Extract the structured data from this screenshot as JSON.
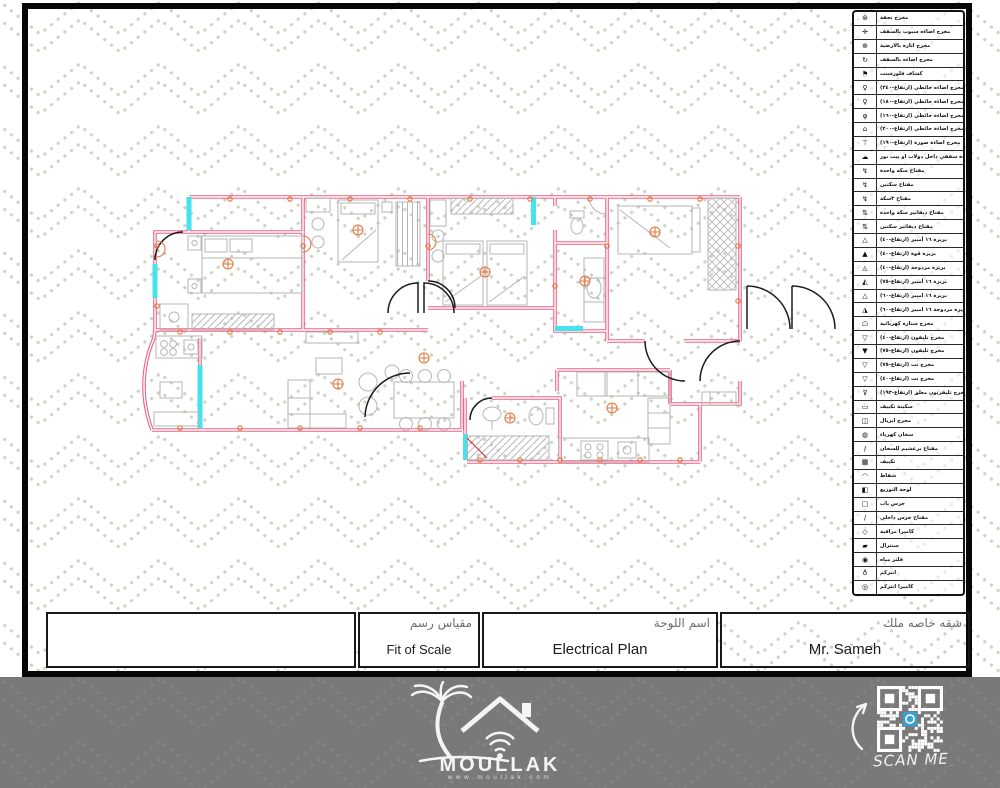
{
  "sheet": {
    "type_label": "Electrical Plan drawing sheet",
    "colors": {
      "pattern_dots": "#ccd5c3",
      "frame": "#070707",
      "walls": "#ef6285",
      "windows": "#45e2ef",
      "furniture": "#b6b6b6",
      "electric_symbols": "#e2793f",
      "doors": "#1c1c1c",
      "footer_bg": "#797979",
      "qr_center_icon": "#3aa0d6"
    }
  },
  "legend": {
    "rows": [
      {
        "icon_name": "chandelier-outlet-icon",
        "glyph": "⊛",
        "label": "مخرج نجفة"
      },
      {
        "icon_name": "ceiling-spot-light-icon",
        "glyph": "✛",
        "label": "مخرج اضاءه سبوت بالسقف"
      },
      {
        "icon_name": "floor-lighting-icon",
        "glyph": "⊕",
        "label": "مخرج انارة بالارضية"
      },
      {
        "icon_name": "ceiling-light-outlet-icon",
        "glyph": "↻",
        "label": "مخرج اضاءه بالسقف"
      },
      {
        "icon_name": "fluorescent-lamp-icon",
        "glyph": "⚑",
        "label": "كشاف فلورسنت"
      },
      {
        "icon_name": "wall-light-240-icon",
        "glyph": "♀",
        "label": "مخرج اضاءه حائطي (ارتفاع-٢٤٠)"
      },
      {
        "icon_name": "wall-light-180-icon",
        "glyph": "♀",
        "label": "مخرج اضاءة حائطي (ارتفاع-١٨٠)"
      },
      {
        "icon_name": "wall-light-160-icon",
        "glyph": "φ",
        "label": "مخرج اضاءة حائطي (ارتفاع-١٦٠)"
      },
      {
        "icon_name": "wall-light-200-icon",
        "glyph": "⌂",
        "label": "مخرج اضاءة حائطي (ارتفاع-٢٠٠)"
      },
      {
        "icon_name": "picture-light-190-icon",
        "glyph": "⊤",
        "label": "مخرج اضاءة صورة (ارتفاع-١٩٠)"
      },
      {
        "icon_name": "closet-ceiling-light-icon",
        "glyph": "☁",
        "label": "مخرج اضاءة سقفي داخل دولاب او بيت نور"
      },
      {
        "icon_name": "switch-one-gang-icon",
        "glyph": "↯",
        "label": "مفتاح سكة واحدة"
      },
      {
        "icon_name": "switch-two-gang-icon",
        "glyph": "↯",
        "label": "مفتاح سكتين"
      },
      {
        "icon_name": "switch-three-gang-icon",
        "glyph": "↯",
        "label": "مفتاح ٣سكة"
      },
      {
        "icon_name": "two-way-switch-one-icon",
        "glyph": "⇅",
        "label": "مفتاح ديفاتير سكة واحدة"
      },
      {
        "icon_name": "two-way-switch-two-icon",
        "glyph": "⇅",
        "label": "مفتاح ديفاتير سكتين"
      },
      {
        "icon_name": "socket-16a-h40-icon",
        "glyph": "△",
        "label": "بريزة ١٦ أمبير (ارتفاع-٤٠)"
      },
      {
        "icon_name": "power-socket-h40-icon",
        "glyph": "▲",
        "label": "بريزة قوة (ارتفاع-٤٠)"
      },
      {
        "icon_name": "double-socket-h40-icon",
        "glyph": "◬",
        "label": "بريزة مزدوجة (ارتفاع-٤٠)"
      },
      {
        "icon_name": "socket-16a-h75-icon",
        "glyph": "◭",
        "label": "بريزة ١٦ أمبير (ارتفاع-٧٥)"
      },
      {
        "icon_name": "socket-16a-h60-icon",
        "glyph": "△",
        "label": "بريزة ١٦ امبير (ارتفاع-٦٠)"
      },
      {
        "icon_name": "double-socket-16a-icon",
        "glyph": "◮",
        "label": "بريزة مزدوجة ١٦ امبير (ارتفاع-٦٠)"
      },
      {
        "icon_name": "electric-curtain-outlet-icon",
        "glyph": "☖",
        "label": "مخرج ستارة كهربائية"
      },
      {
        "icon_name": "phone-outlet-h40-icon",
        "glyph": "▽",
        "label": "مخرج تليفون (ارتفاع-٤٠)"
      },
      {
        "icon_name": "phone-outlet-h75-icon",
        "glyph": "▼",
        "label": "مخرج تليفون (ارتفاع-٧٥)"
      },
      {
        "icon_name": "net-outlet-h75-icon",
        "glyph": "▽",
        "label": "مخرج نت (ارتفاع-٧٥)"
      },
      {
        "icon_name": "net-outlet-h40-icon",
        "glyph": "▽",
        "label": "مخرج نت (ارتفاع-٤٠)"
      },
      {
        "icon_name": "wall-tv-outlet-icon",
        "glyph": "⊽",
        "label": "مخرج تليفزيون معلق (ارتفاع-١٩٣)"
      },
      {
        "icon_name": "ac-isolator-icon",
        "glyph": "▭",
        "label": "سكينة تكييف"
      },
      {
        "icon_name": "aerial-outlet-icon",
        "glyph": "◫",
        "label": "مخرج ايريال"
      },
      {
        "icon_name": "water-heater-icon",
        "glyph": "◍",
        "label": "سخان كهرباء"
      },
      {
        "icon_name": "heater-switch-icon",
        "glyph": "∕",
        "label": "مفتاح برغشيم للسخان"
      },
      {
        "icon_name": "air-conditioner-icon",
        "glyph": "▦",
        "label": "تكييف"
      },
      {
        "icon_name": "exhaust-fan-icon",
        "glyph": "◠",
        "label": "شفاط"
      },
      {
        "icon_name": "distribution-board-icon",
        "glyph": "◧",
        "label": "لوحة التوزيع"
      },
      {
        "icon_name": "door-bell-icon",
        "glyph": "▢",
        "label": "جرس باب"
      },
      {
        "icon_name": "indoor-bell-switch-icon",
        "glyph": "∕",
        "label": "مفتاح جرس داخلي"
      },
      {
        "icon_name": "cctv-camera-icon",
        "glyph": "◇",
        "label": "كاميرا مراقبة"
      },
      {
        "icon_name": "central-icon",
        "glyph": "▰",
        "label": "سنترال"
      },
      {
        "icon_name": "water-filter-icon",
        "glyph": "◉",
        "label": "فلتر مياه"
      },
      {
        "icon_name": "intercom-icon",
        "glyph": "♁",
        "label": "انتركم"
      },
      {
        "icon_name": "intercom-camera-icon",
        "glyph": "◎",
        "label": "كاميرا انتركم"
      }
    ]
  },
  "title_block": {
    "scale": {
      "label_ar": "مقياس رسم",
      "value_en": "Fit of Scale"
    },
    "sheet": {
      "label_ar": "اسم اللوحة",
      "value_en": "Electrical Plan"
    },
    "owner": {
      "label_ar": "شقه خاصه ملك",
      "value_en": "Mr. Sameh"
    }
  },
  "footer": {
    "brand": "MOULLAK",
    "website": "www.moullak.com",
    "scan_label": "SCAN ME"
  }
}
